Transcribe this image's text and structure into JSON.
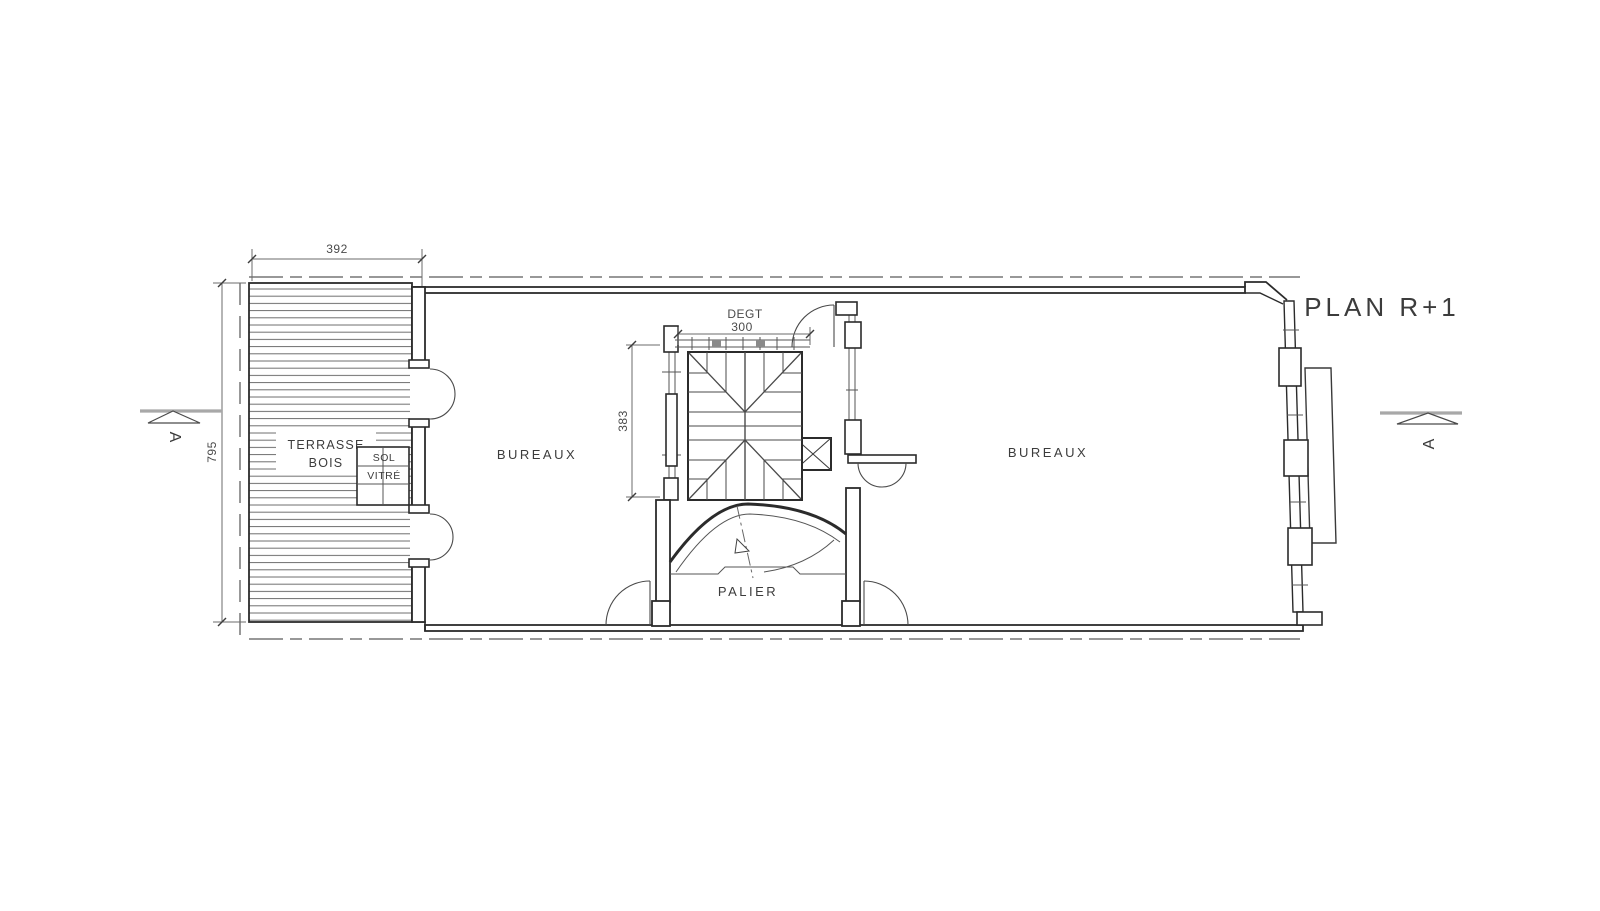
{
  "title": "PLAN R+1",
  "rooms": {
    "terrace": {
      "label_line1": "TERRASSE",
      "label_line2": "BOIS"
    },
    "glass_floor": {
      "label_line1": "SOL",
      "label_line2": "VITRÉ"
    },
    "office_left": {
      "label": "BUREAUX"
    },
    "office_right": {
      "label": "BUREAUX"
    },
    "landing": {
      "label": "PALIER"
    },
    "stairwell": {
      "label": "DEGT"
    }
  },
  "dimensions": {
    "terrace_width": "392",
    "building_depth": "795",
    "stair_width": "300",
    "stair_depth": "383"
  },
  "section_markers": {
    "left_label": "A",
    "right_label": "A"
  },
  "colors": {
    "background": "#ffffff",
    "wall_line": "#2b2b2b",
    "thin_line": "#555555",
    "dimension_line": "#6b6b6b",
    "section_marker_gray": "#a8a8a8",
    "text": "#3c3c3c"
  }
}
